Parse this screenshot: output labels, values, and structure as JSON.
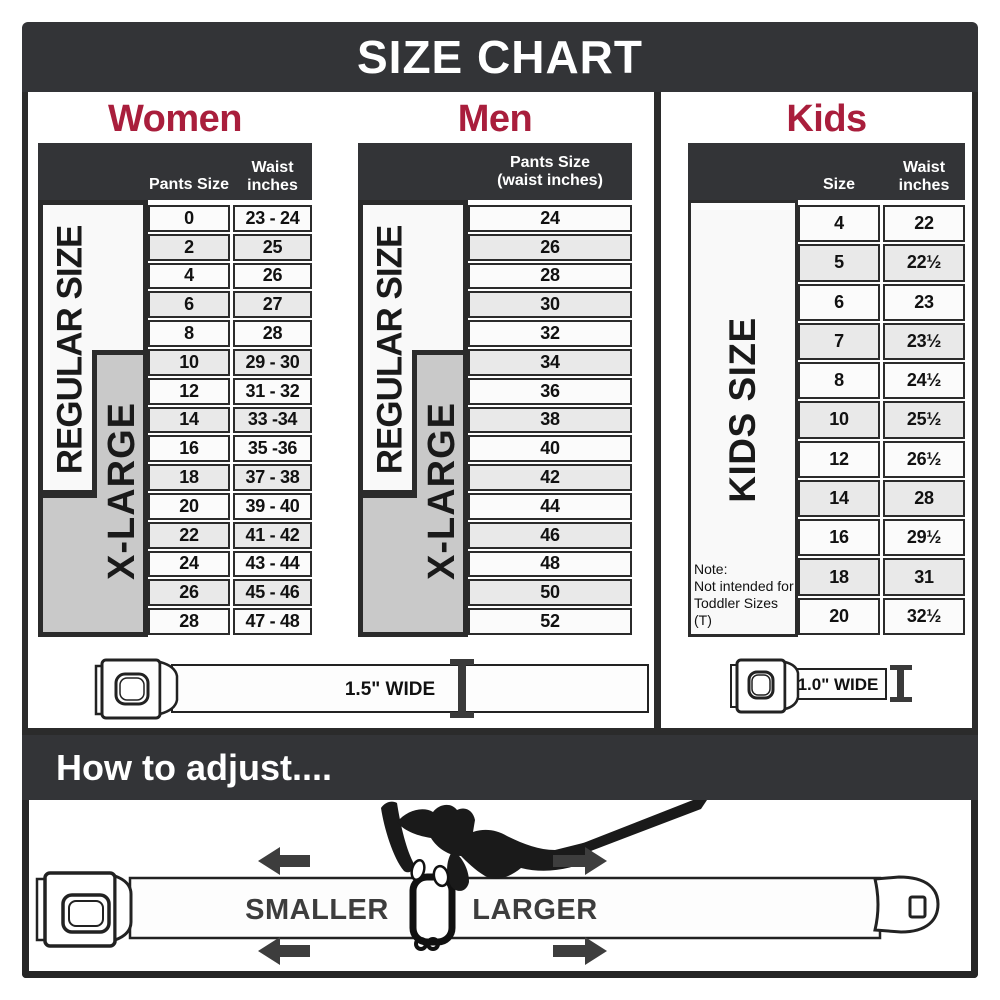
{
  "title": "SIZE CHART",
  "colors": {
    "accent": "#a91e3c",
    "bar": "#333437",
    "row_alt": "#e9e9e9",
    "xlarge_gray": "#c9c9c9"
  },
  "women": {
    "heading": "Women",
    "regular_label": "REGULAR SIZE",
    "xlarge_label": "X-LARGE",
    "col1_header": "Pants Size",
    "col2_header": "Waist\ninches",
    "rows": [
      [
        "0",
        "23 - 24"
      ],
      [
        "2",
        "25"
      ],
      [
        "4",
        "26"
      ],
      [
        "6",
        "27"
      ],
      [
        "8",
        "28"
      ],
      [
        "10",
        "29 - 30"
      ],
      [
        "12",
        "31 - 32"
      ],
      [
        "14",
        "33 -34"
      ],
      [
        "16",
        "35 -36"
      ],
      [
        "18",
        "37 - 38"
      ],
      [
        "20",
        "39 - 40"
      ],
      [
        "22",
        "41 - 42"
      ],
      [
        "24",
        "43 - 44"
      ],
      [
        "26",
        "45 - 46"
      ],
      [
        "28",
        "47 - 48"
      ]
    ],
    "belt_width_label": "1.5\" WIDE"
  },
  "men": {
    "heading": "Men",
    "regular_label": "REGULAR SIZE",
    "xlarge_label": "X-LARGE",
    "col_header": "Pants Size\n(waist inches)",
    "rows": [
      "24",
      "26",
      "28",
      "30",
      "32",
      "34",
      "36",
      "38",
      "40",
      "42",
      "44",
      "46",
      "48",
      "50",
      "52"
    ]
  },
  "kids": {
    "heading": "Kids",
    "side_label": "KIDS SIZE",
    "col1_header": "Size",
    "col2_header": "Waist\ninches",
    "rows": [
      [
        "4",
        "22"
      ],
      [
        "5",
        "22½"
      ],
      [
        "6",
        "23"
      ],
      [
        "7",
        "23½"
      ],
      [
        "8",
        "24½"
      ],
      [
        "10",
        "25½"
      ],
      [
        "12",
        "26½"
      ],
      [
        "14",
        "28"
      ],
      [
        "16",
        "29½"
      ],
      [
        "18",
        "31"
      ],
      [
        "20",
        "32½"
      ]
    ],
    "note": "Note:\nNot intended for\nToddler Sizes (T)",
    "belt_width_label": "1.0\" WIDE"
  },
  "adjust": {
    "heading": "How to adjust....",
    "smaller_label": "SMALLER",
    "larger_label": "LARGER"
  },
  "icons": {
    "buckle": "seatbelt-buckle-icon",
    "width_marker": "i-beam-width-marker-icon",
    "hand": "pinching-hand-icon",
    "arrows": "direction-arrow-icons"
  }
}
